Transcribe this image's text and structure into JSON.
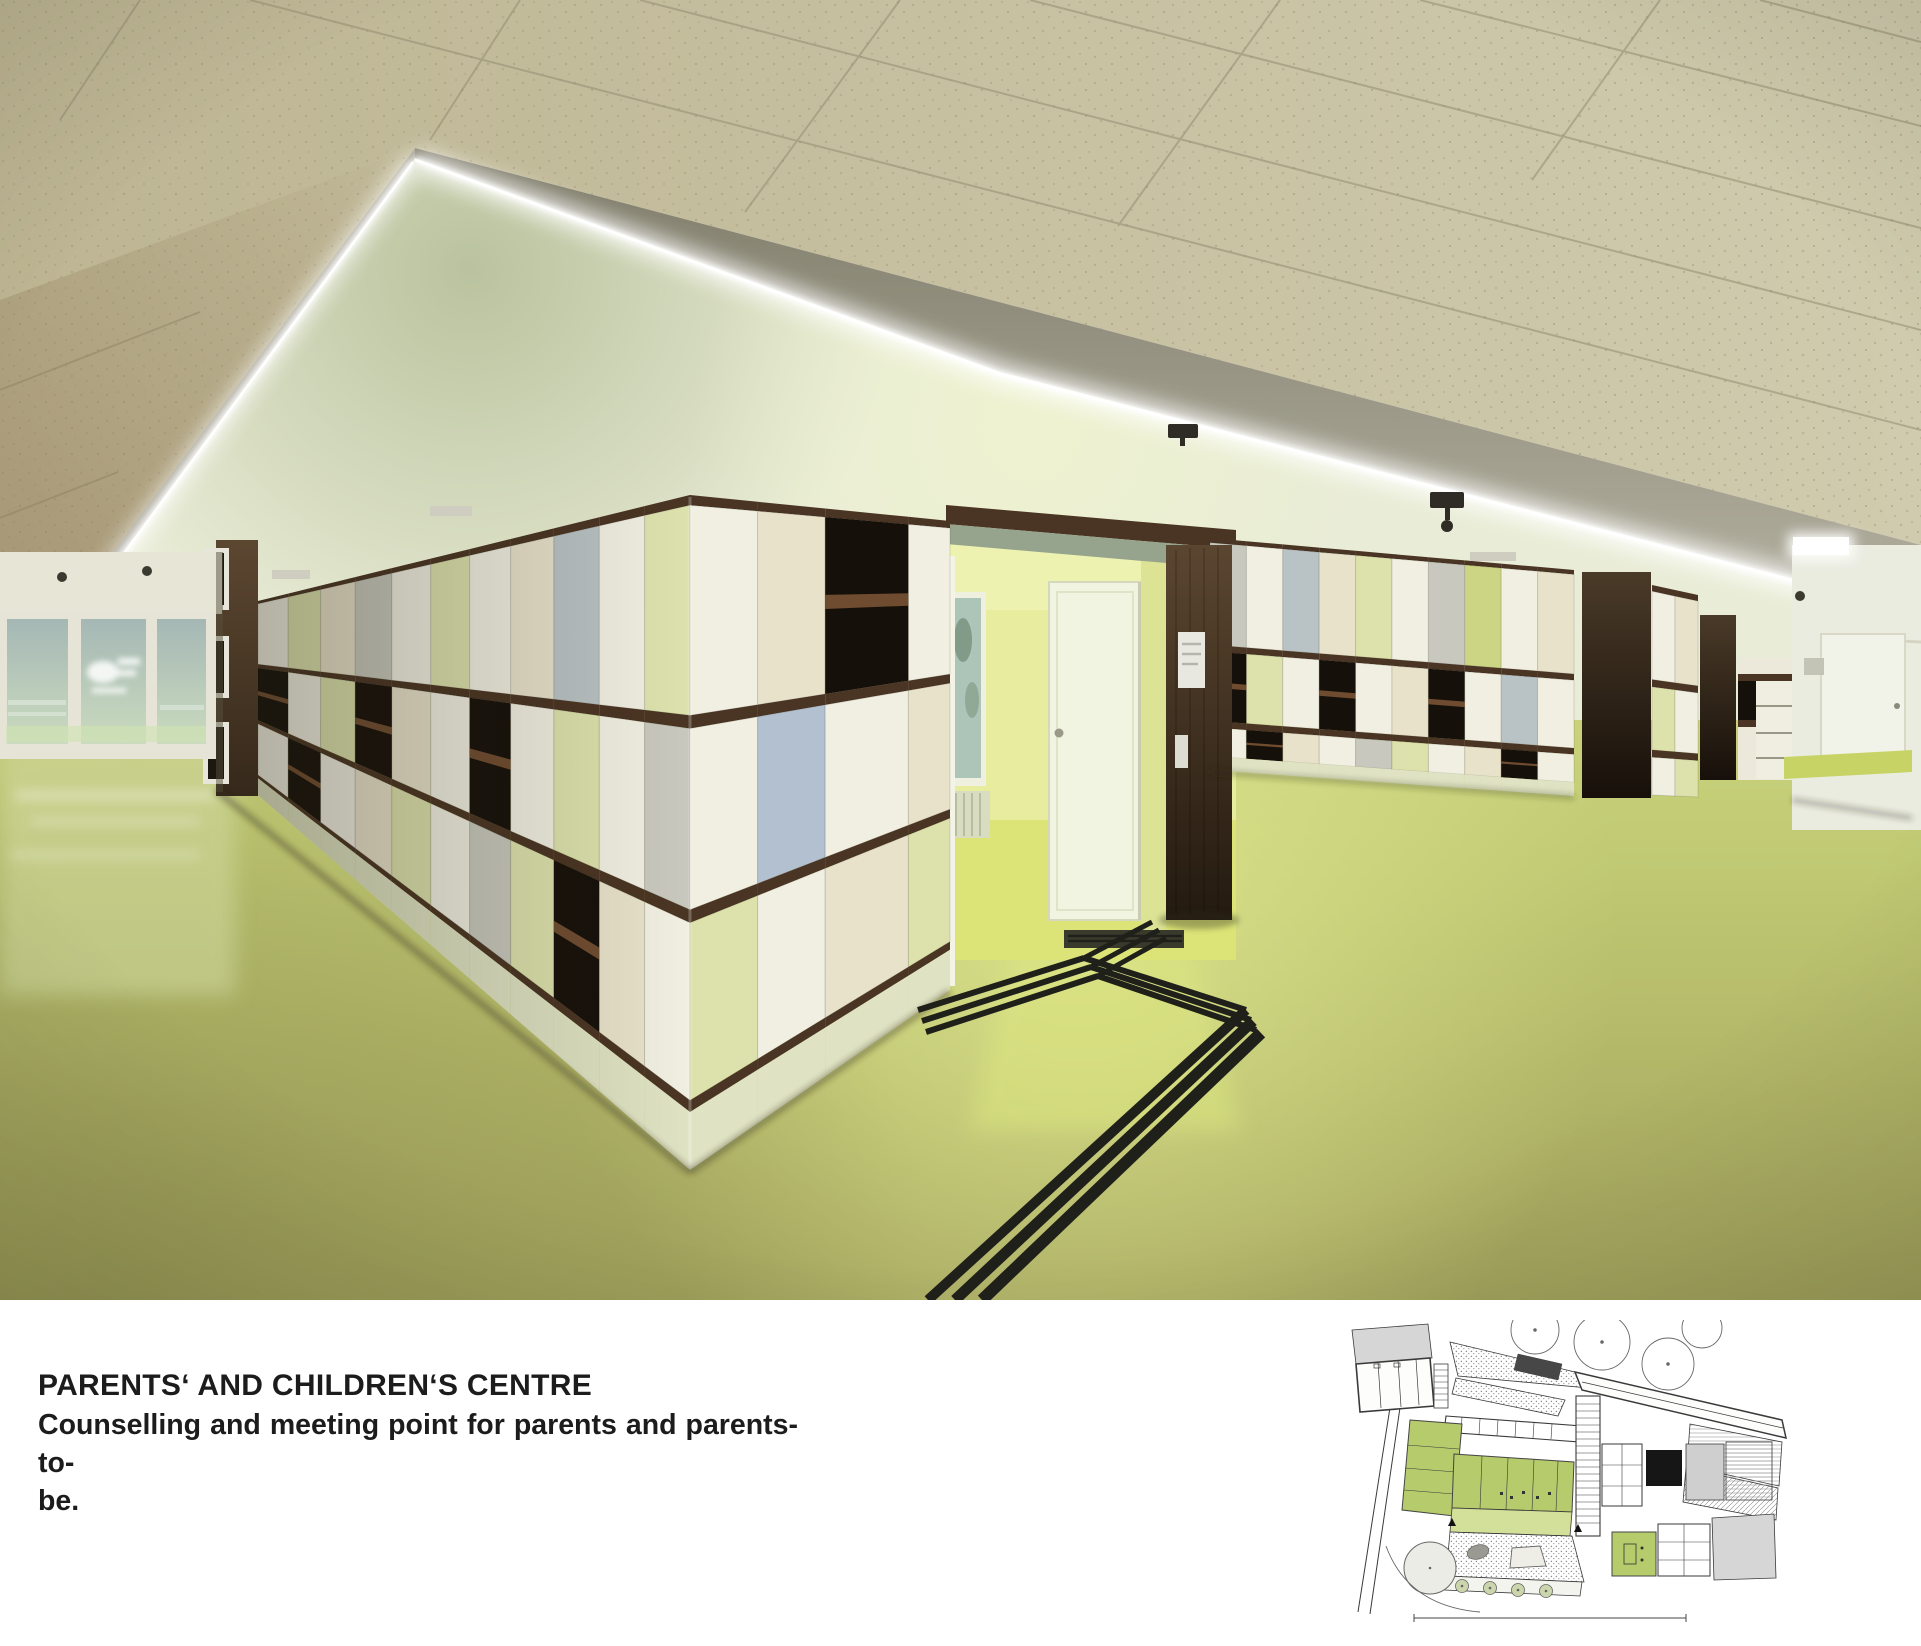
{
  "caption": {
    "title": "PARENTS‘ AND CHILDREN‘S CENTRE",
    "lines": [
      "Counselling and meeting point for parents and parents-to-",
      "be."
    ]
  },
  "colors": {
    "paper": "#ffffff",
    "text": "#1c1c1c",
    "tileLeft": "#bdb593",
    "tileRight": "#d0cbae",
    "joint": "#948c72",
    "shadowTint": "#8b7352",
    "fasciaTop": "#7f7c6a",
    "fasciaBot": "#b3b0a0",
    "soffitBase": "#e9ecd6",
    "soffitGreen": "#aeb890",
    "glow": "#ffffff",
    "trim": "#4a3423",
    "shelf": "#6f4c30",
    "cubby": "#16100a",
    "panelWhite": "#f1efe2",
    "panelCream": "#e8e2cb",
    "panelPaleGreen": "#dde2ad",
    "panelGreen": "#ccd584",
    "panelGray": "#c8c8be",
    "panelBlueGray": "#b9c2c4",
    "panelBlue": "#b2c0d0",
    "plinth": "#dfe3c3",
    "floorTop": "#d2da86",
    "floorMid": "#c2cb74",
    "floorBottom": "#a1a25c",
    "floorLight": "#e2ea92",
    "floorDark": "#8b8c4e",
    "floorPaleLeft": "#d2daa0",
    "innerWall": "#e7ec9e",
    "innerWallLight": "#eff3b4",
    "innerFloor": "#dce478",
    "innerDoor": "#f2f4e2",
    "glassTop": "#a3b6b4",
    "glassBot": "#cfdfc0",
    "frame": "#e6e4d6",
    "pocketTop": "#5b4630",
    "pocketBot": "#241a10",
    "recessTop": "#4a3a28",
    "recessBot": "#17100a",
    "corridorWall": "#ebece0",
    "corridorDoor": "#f2f3e8",
    "corridorBase": "#c7d465",
    "pathLine": "#20201a",
    "fixtureDark": "#2e2c24",
    "vent": "#cfccc0"
  },
  "scene": {
    "palette": {
      "W": "panelWhite",
      "C": "panelCream",
      "G": "panelPaleGreen",
      "g": "panelGreen",
      "S": "panelGray",
      "B": "panelBlueGray",
      "L": "panelBlue",
      "K": "cubby",
      "P": "plinth"
    },
    "walls": [
      {
        "name": "wall-left",
        "x0": 258,
        "x1": 690,
        "top0": 601,
        "top1": 495,
        "bot0": 795,
        "bot1": 1170,
        "rows": [
          [
            "trim",
            0.014
          ],
          [
            "p",
            0.29
          ],
          [
            "trim",
            0.018
          ],
          [
            "p",
            0.25
          ],
          [
            "trim",
            0.018
          ],
          [
            "p",
            0.245
          ],
          [
            "trim",
            0.016
          ],
          [
            "plinth",
            0.08
          ]
        ],
        "u": [
          0,
          0.07,
          0.145,
          0.225,
          0.31,
          0.4,
          0.49,
          0.585,
          0.685,
          0.79,
          0.895,
          1.0
        ],
        "cells": [
          [
            "W",
            "K",
            "W"
          ],
          [
            "G",
            "W",
            "K"
          ],
          [
            "C",
            "G",
            "W"
          ],
          [
            "S",
            "K",
            "C"
          ],
          [
            "W",
            "C",
            "G"
          ],
          [
            "G",
            "W",
            "W"
          ],
          [
            "W",
            "K",
            "S"
          ],
          [
            "C",
            "W",
            "G"
          ],
          [
            "B",
            "G",
            "K"
          ],
          [
            "W",
            "W",
            "C"
          ],
          [
            "G",
            "S",
            "W"
          ]
        ]
      },
      {
        "name": "wall-front",
        "x0": 690,
        "x1": 950,
        "top0": 495,
        "top1": 521,
        "bot0": 1170,
        "bot1": 990,
        "rows": [
          [
            "trim",
            0.014
          ],
          [
            "p",
            0.29
          ],
          [
            "trim",
            0.018
          ],
          [
            "p",
            0.25
          ],
          [
            "trim",
            0.018
          ],
          [
            "p",
            0.245
          ],
          [
            "trim",
            0.016
          ],
          [
            "plinth",
            0.08
          ]
        ],
        "u": [
          0,
          0.26,
          0.52,
          0.84,
          1.0
        ],
        "cells": [
          [
            "W",
            "W",
            "G"
          ],
          [
            "C",
            "L",
            "W"
          ],
          [
            "K",
            "W",
            "C"
          ],
          [
            "W",
            "C",
            "G"
          ]
        ]
      },
      {
        "name": "wall-right-b",
        "x0": 1210,
        "x1": 1574,
        "top0": 538,
        "top1": 570,
        "bot0": 770,
        "bot1": 796,
        "rows": [
          [
            "trim",
            0.02
          ],
          [
            "p",
            0.44
          ],
          [
            "trim",
            0.028
          ],
          [
            "p",
            0.3
          ],
          [
            "trim",
            0.028
          ],
          [
            "p",
            0.124
          ],
          [
            "plinth",
            0.06
          ]
        ],
        "u": [
          0,
          0.1,
          0.2,
          0.3,
          0.4,
          0.5,
          0.6,
          0.7,
          0.8,
          0.9,
          1.0
        ],
        "cells": [
          [
            "S",
            "K",
            "W"
          ],
          [
            "W",
            "G",
            "K"
          ],
          [
            "B",
            "W",
            "C"
          ],
          [
            "C",
            "K",
            "W"
          ],
          [
            "G",
            "W",
            "S"
          ],
          [
            "W",
            "C",
            "G"
          ],
          [
            "S",
            "K",
            "W"
          ],
          [
            "g",
            "W",
            "C"
          ],
          [
            "W",
            "B",
            "K"
          ],
          [
            "C",
            "W",
            "W"
          ]
        ]
      },
      {
        "name": "wall-right-c",
        "x0": 1652,
        "x1": 1698,
        "top0": 585,
        "top1": 595,
        "bot0": 795,
        "bot1": 797,
        "rows": [
          [
            "trim",
            0.03
          ],
          [
            "p",
            0.42
          ],
          [
            "trim",
            0.035
          ],
          [
            "p",
            0.3
          ],
          [
            "trim",
            0.035
          ],
          [
            "p",
            0.18
          ]
        ],
        "u": [
          0,
          0.5,
          1.0
        ],
        "cells": [
          [
            "W",
            "G",
            "W"
          ],
          [
            "C",
            "W",
            "G"
          ]
        ]
      }
    ]
  },
  "plan": {
    "green": "#b6cb6b",
    "greenLight": "#d3e09a",
    "gray": "#d6d6d6",
    "grayMid": "#cfcfcf",
    "line": "#3a3a3a",
    "black": "#161616",
    "dots": "#8f8f8f",
    "white": "#fdfdfb"
  }
}
